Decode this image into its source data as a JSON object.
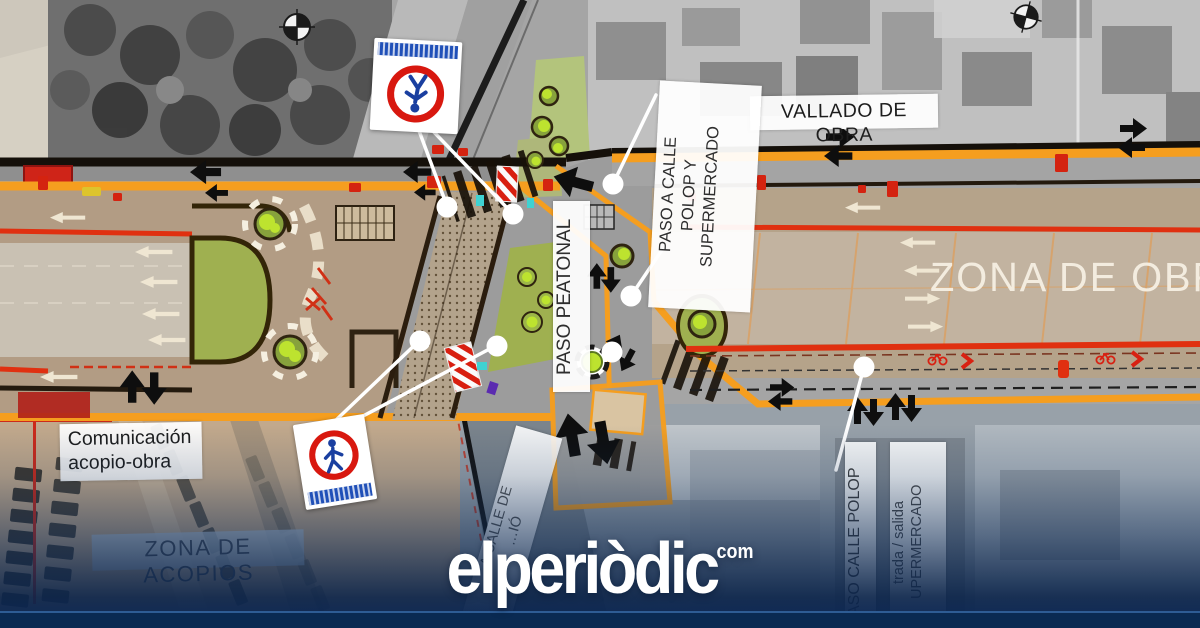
{
  "site": {
    "logo": "elperiòdic",
    "logo_suffix": "com"
  },
  "labels": {
    "vallado_de_obra": "VALLADO DE OBRA",
    "paso_a_calle": {
      "line1": "PASO A CALLE",
      "line2": "POLOP Y",
      "line3": "SUPERMERCADO"
    },
    "paso_peatonal": "PASO PEATONAL",
    "zona_de_obra": "ZONA DE OBRA",
    "comunicacion": {
      "line1": "Comunicación",
      "line2": "acopio-obra"
    },
    "zona_de_acopios": "ZONA DE ACOPIOS",
    "calle_de_diagonal": {
      "line1": "A CALLE DE",
      "line2": "…IÓ"
    },
    "paso_calle_polop_vertical": "ASO CALLE POLOP",
    "entrada_salida": {
      "line1": "trada / salida",
      "line2": "UPERMERCADO"
    }
  },
  "icons": {
    "sign_top": "no-pedestrians-sign",
    "sign_bottom": "pedestrians-sign",
    "compass": "compass-rose",
    "arrows": "direction-arrows"
  },
  "colors": {
    "fence_orange": "#f59e1f",
    "works_red": "#e03010",
    "sign_red": "#d8180f",
    "sign_blue": "#1a3fa0",
    "brand_navy": "#0b2757"
  }
}
